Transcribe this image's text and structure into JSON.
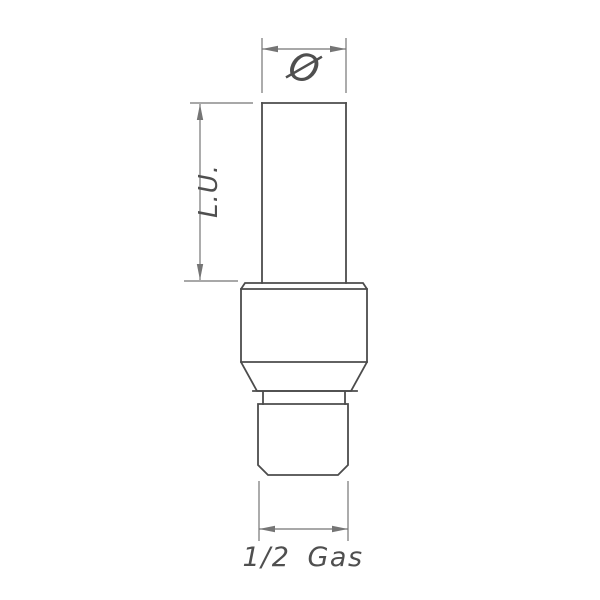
{
  "drawing": {
    "dimensions": {
      "diameter_label": "Ø",
      "length_label": "L.U.",
      "thread_label": "1/2 Gas"
    },
    "colors": {
      "background": "#ffffff",
      "object_line": "#4c4c4c",
      "dimension_line": "#757575",
      "text": "#4f4f4f"
    }
  }
}
